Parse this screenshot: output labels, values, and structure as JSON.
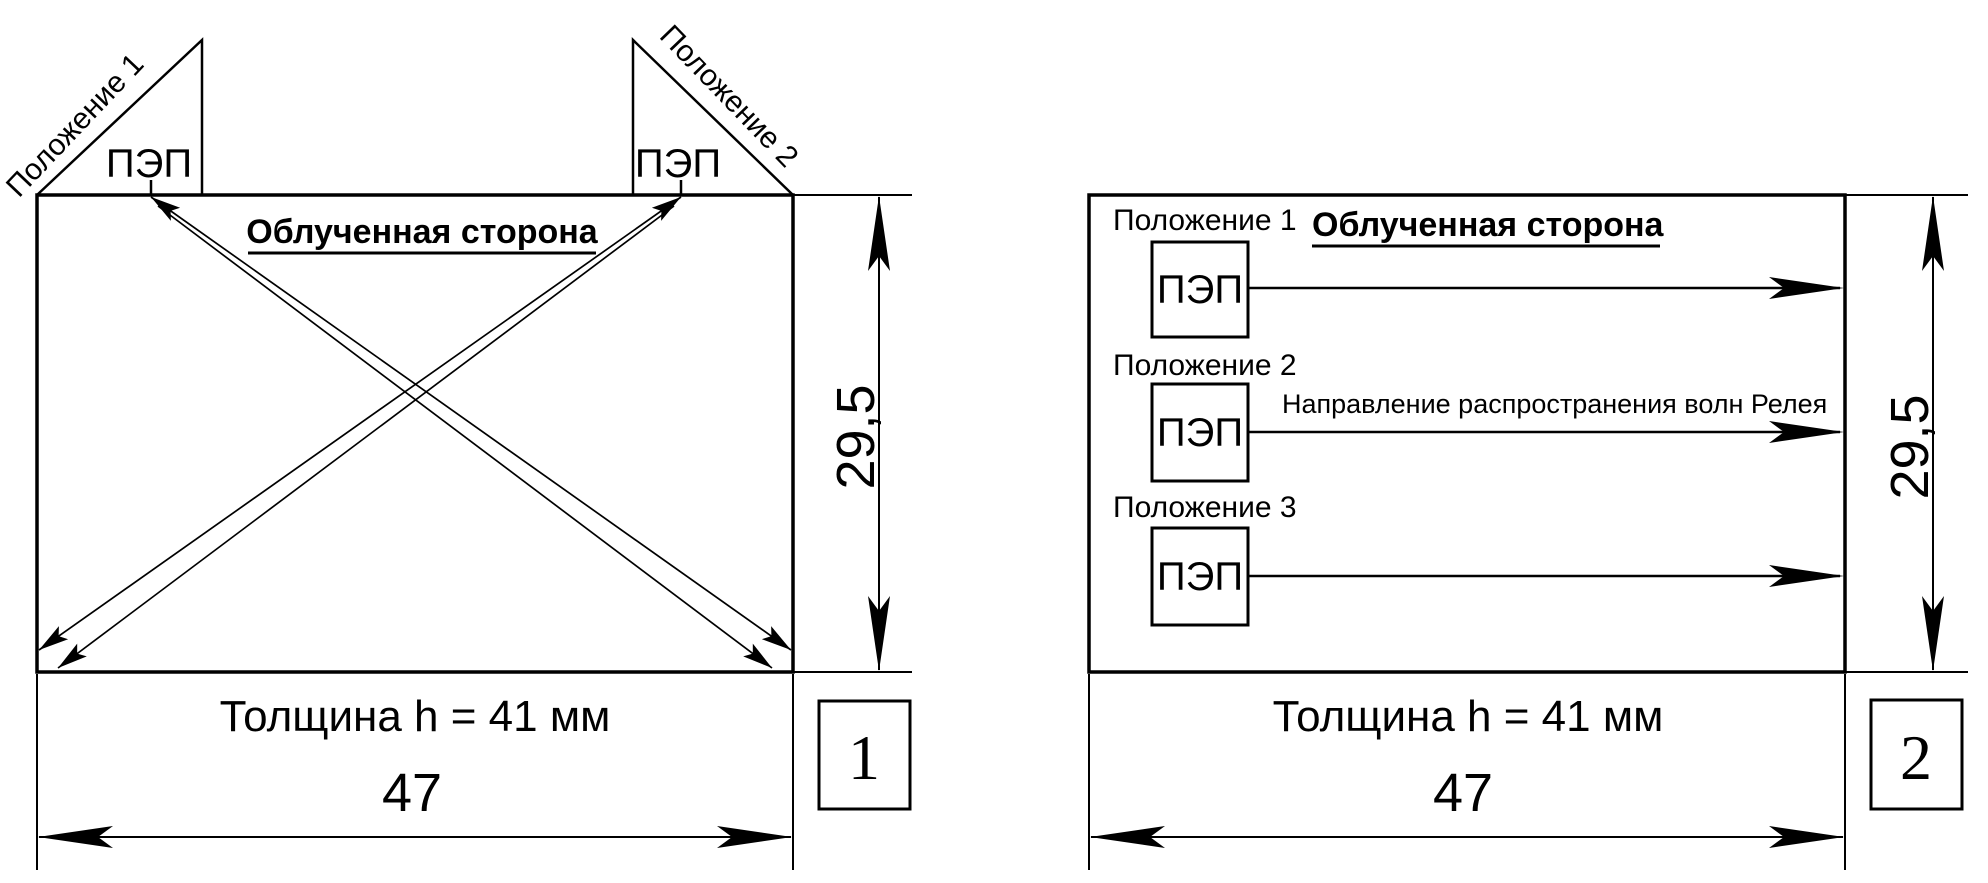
{
  "figure": {
    "background": "#ffffff",
    "ink": "#000000"
  },
  "panel1": {
    "figure_number": "1",
    "irradiated_side": "Облученная сторона",
    "position1": "Положение 1",
    "position2": "Положение 2",
    "transducer": "ПЭП",
    "height_dim": "29,5",
    "thickness": "Толщина h = 41 мм",
    "width_dim": "47"
  },
  "panel2": {
    "figure_number": "2",
    "irradiated_side": "Облученная сторона",
    "position1": "Положение 1",
    "position2": "Положение 2",
    "position3": "Положение 3",
    "transducer": "ПЭП",
    "rayleigh_direction": "Направление распространения волн Релея",
    "height_dim": "29,5",
    "thickness": "Толщина h = 41 мм",
    "width_dim": "47"
  }
}
